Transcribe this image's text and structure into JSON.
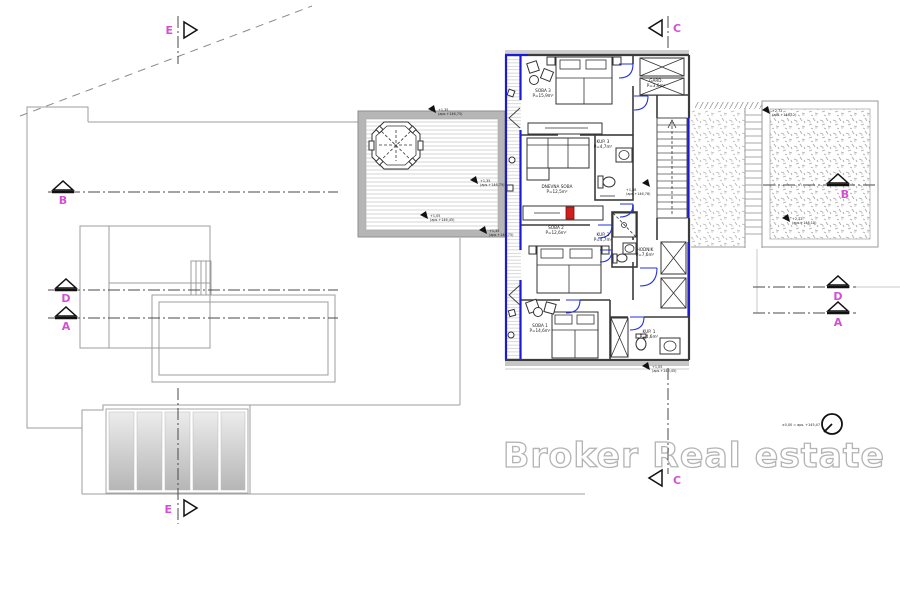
{
  "drawing": {
    "watermark": "Broker Real estate",
    "level_note": "±0,00 = aps. +145,47"
  },
  "section_markers": {
    "top_e": "E",
    "top_c": "C",
    "left_b": "B",
    "left_d": "D",
    "left_a": "A",
    "right_b": "B",
    "right_d": "D",
    "right_a": "A",
    "bottom_e": "E",
    "bottom_c": "C"
  },
  "rooms": {
    "soba3": {
      "name": "SOBA 3",
      "area": "P=15,9m²"
    },
    "garderoba": {
      "name": "GARD.",
      "area": "P=3,6m²"
    },
    "kup3": {
      "name": "KUP. 3",
      "area": "P=4,7m²"
    },
    "dnevna": {
      "name": "DNEVNA SOBA",
      "area": "P=12,5m²"
    },
    "hodnik": {
      "name": "HODNIK",
      "area": "P=7,6m²"
    },
    "soba2": {
      "name": "SOBA 2",
      "area": "P=12,6m²"
    },
    "kup2": {
      "name": "KUP. 2",
      "area": "P=4,7m²"
    },
    "soba1": {
      "name": "SOBA 1",
      "area": "P=14,6m²"
    },
    "kup1": {
      "name": "KUP. 1",
      "area": "P=4,6m²"
    }
  },
  "elevation_flags": {
    "f1": {
      "v": "+1,35",
      "abs": "(aps.+146,75)"
    },
    "f2": {
      "v": "+1,35",
      "abs": "(aps.+146,75)"
    },
    "f3": {
      "v": "+1,05",
      "abs": "(aps.+146,45)"
    },
    "f4": {
      "v": "+1,35",
      "abs": "(aps.+146,75)"
    },
    "f5": {
      "v": "+1,38",
      "abs": "(aps.+146,78)"
    },
    "f6": {
      "v": "+2,72",
      "abs": "(aps.+148,12)"
    },
    "f7": {
      "v": "+2,72",
      "abs": "(aps.+148,12)"
    },
    "f8": {
      "v": "+1,05",
      "abs": "(aps.+146,45)"
    }
  },
  "colors": {
    "section_label": "#d44fd4",
    "highlight_wall": "#1a1ad8",
    "accent_red": "#cf1f1f",
    "watermark_outline": "#b4b4b4"
  }
}
